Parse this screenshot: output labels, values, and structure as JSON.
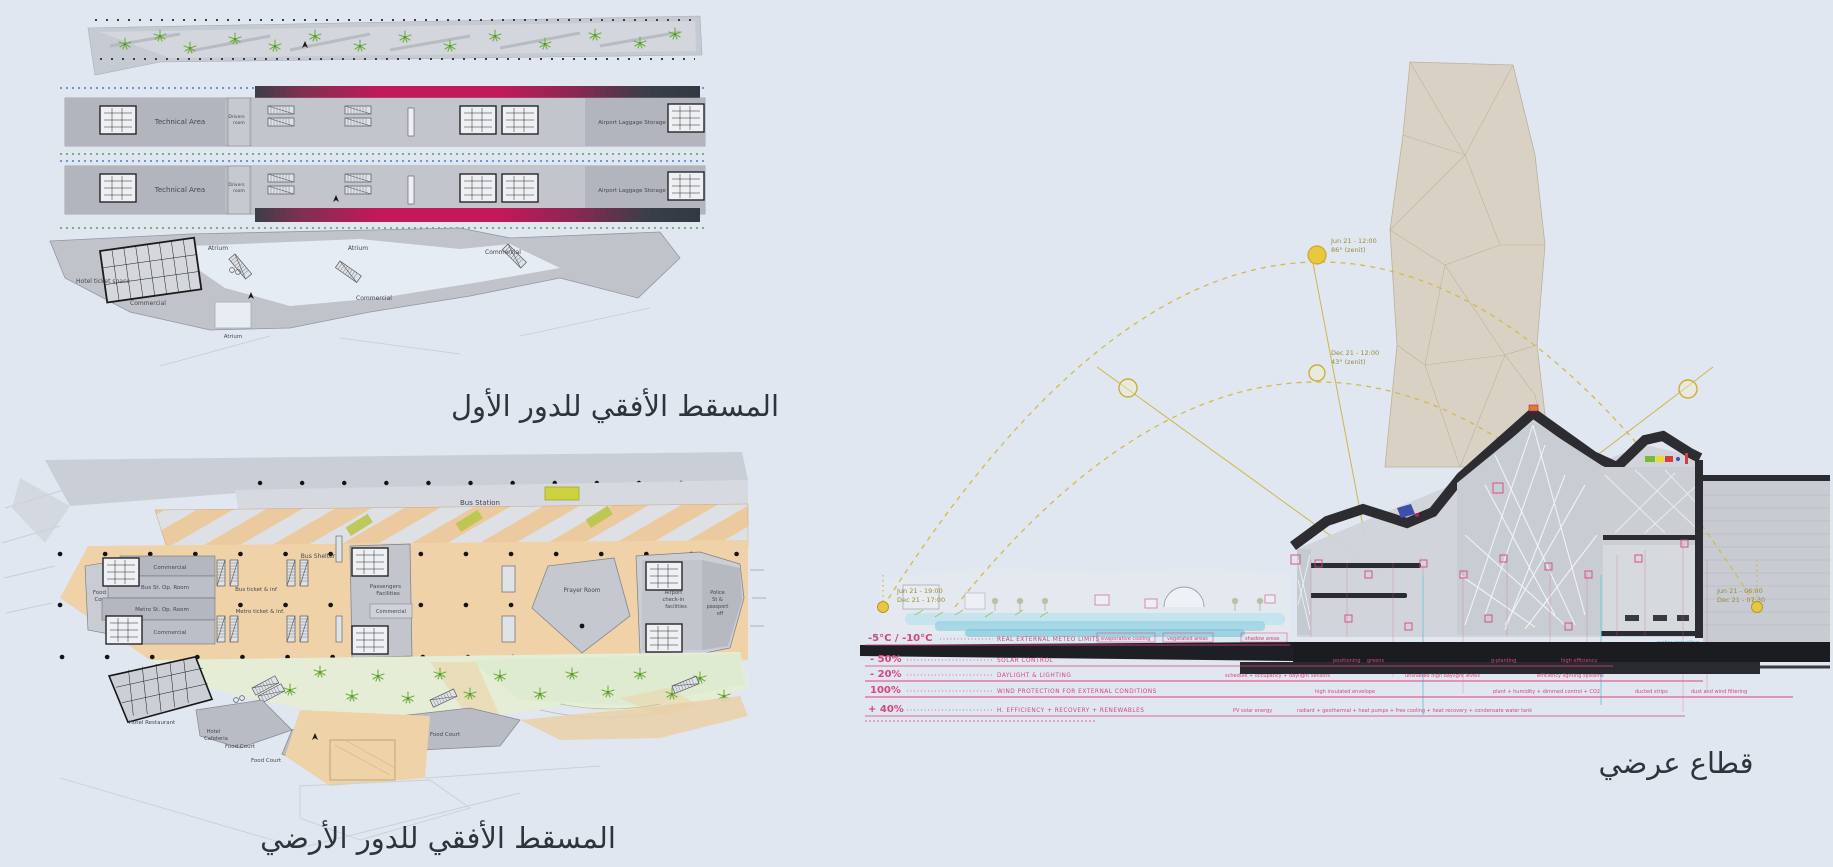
{
  "colors": {
    "paper": "#e0e7f1",
    "plan_grey": "#b9bcc3",
    "plaza_orange": "#f0d2a8",
    "garden_green": "#e6edd6",
    "palm_green": "#6fae3f",
    "train_magenta": "#c2195a",
    "sun_yellow": "#e9c73e",
    "annotation_pink": "#d8457d",
    "cyan": "#79c7d9",
    "tower_beige": "#d9d2c4",
    "section_dark": "#26272b"
  },
  "captions": {
    "first_floor": "المسقط الأفقي للدور الأول",
    "ground_floor": "المسقط الأفقي للدور الأرضي",
    "section": "قطاع عرضي"
  },
  "first_floor_plan": {
    "technical_area_1": "Technical Area",
    "technical_area_2": "Technical Area",
    "drivers_room_lines": [
      "Drivers",
      "room"
    ],
    "luggage_1": "Airport Laggage Storage",
    "luggage_2": "Airport Laggage Storage",
    "hotel_ticket": "Hotel ticket space",
    "commercial_1": "Commercial",
    "commercial_2": "Commercial",
    "commercial_3": "Commercial",
    "atrium_1": "Atrium",
    "atrium_2": "Atrium",
    "atrium_3": "Atrium"
  },
  "ground_floor_plan": {
    "bus_station": "Bus Station",
    "bus_shelter": "Bus Shelter",
    "commercial_top": "Commercial",
    "bus_op_room": "Bus St. Op. Room",
    "metro_op_room": "Metro St. Op. Room",
    "commercial_2": "Commercial",
    "food_court_left_lines": [
      "Food",
      "Court"
    ],
    "bus_ticket": "Bus ticket & inf",
    "metro_ticket": "Metro ticket & inf.",
    "passengers_lines": [
      "Passengers",
      "Facilities"
    ],
    "commercial_mid": "Commercial",
    "prayer_room": "Prayer Room",
    "airport_checkin_lines": [
      "Airport",
      "check-in",
      "facilities"
    ],
    "police_lines": [
      "Police",
      "St &",
      "passport",
      "off"
    ],
    "hotel_restaurant": "Hotel Restaurant",
    "hotel_cafeteria_lines": [
      "Hotel",
      "Cafeteria"
    ],
    "food_court_1": "Food Court",
    "food_court_2": "Food Court",
    "food_court_3": "Food Court"
  },
  "section": {
    "sun": {
      "noon_jun": "Jun 21 - 12:00",
      "noon_jun_angle": "86° (zenit)",
      "noon_dec": "Dec 21 - 12:00",
      "noon_dec_angle": "43° (zenit)",
      "west_jun": "Jun 21 - 19:00",
      "west_dec": "Dec 21 - 17:00",
      "east_jun": "Jun 21 - 06:00",
      "east_dec": "Dec 21 - 07:30"
    },
    "legend": {
      "rows": [
        {
          "value": "-5°C / -10°C",
          "desc": "REAL EXTERNAL METEO LIMITS",
          "tags": [
            "evaporative cooling",
            "vegetated areas",
            "shadow areas"
          ]
        },
        {
          "value": "- 50%",
          "desc": "SOLAR CONTROL",
          "tags": [
            "positioning",
            "greens",
            "g-planting",
            "high efficiency"
          ]
        },
        {
          "value": "- 20%",
          "desc": "DAYLIGHT & LIGHTING",
          "tags": [
            "schedule + occupancy + daylight sensors",
            "unshaded high daylight levels",
            "efficiency lighting systems"
          ]
        },
        {
          "value": "100%",
          "desc": "WIND PROTECTION FOR EXTERNAL CONDITIONS",
          "tags": [
            "high insulated envelope",
            "plant + humidity + dimmed control + CO2",
            "ducted strips",
            "dust and wind filtering"
          ]
        },
        {
          "value": "+ 40%",
          "desc": "H. EFFICIENCY + RECOVERY + RENEWABLES",
          "tags": [
            "PV solar energy",
            "radiant + geothermal + heat pumps + free cooling + heat recovery + condensate water tank"
          ]
        }
      ],
      "water_note": "water recycling"
    }
  }
}
